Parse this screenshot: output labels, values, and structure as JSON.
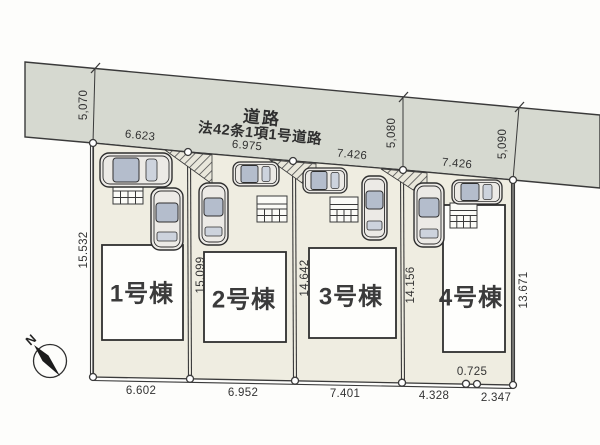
{
  "plan": {
    "road": {
      "label_line1": "道路",
      "label_line2": "法42条1項1号道路",
      "width_dims": [
        "5,070",
        "5,080",
        "5,090"
      ]
    },
    "frontage_dims": [
      "6.623",
      "6.975",
      "7.426",
      "7.426"
    ],
    "depth_dims": [
      "15.532",
      "15.099",
      "14.642",
      "14.156",
      "13.671"
    ],
    "bottom_dims": [
      "6.602",
      "6.952",
      "7.401",
      "4.328",
      "0.725",
      "2.347"
    ],
    "buildings": [
      {
        "label": "1号棟"
      },
      {
        "label": "2号棟"
      },
      {
        "label": "3号棟"
      },
      {
        "label": "4号棟"
      }
    ],
    "compass": {
      "north_label": "N"
    },
    "colors": {
      "road_fill": "#d6d9d0",
      "plot_fill": "#efede1",
      "building_fill": "#fefefc",
      "line": "#3a3a3a",
      "car_body": "#eceae6",
      "car_window": "#b4bdcc"
    }
  }
}
